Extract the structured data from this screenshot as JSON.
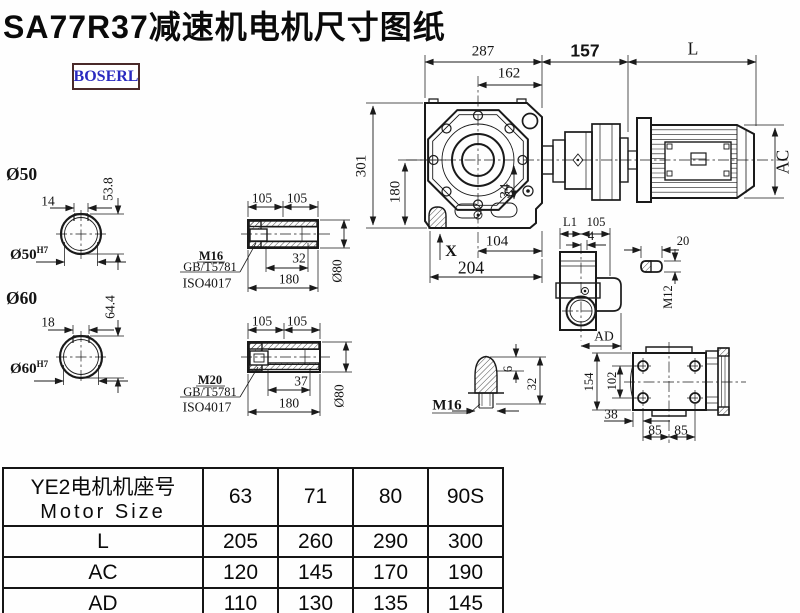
{
  "title": "SA77R37减速机电机尺寸图纸",
  "logo": "BOSERL",
  "colors": {
    "ink": "#1a1a1a",
    "logo_text": "#2a2ac0",
    "logo_border": "#4a2a2a"
  },
  "main_view": {
    "dim_287": "287",
    "dim_162": "162",
    "dim_157": "157",
    "dim_L": "L",
    "dim_301": "301",
    "dim_180": "180",
    "dim_34": "34",
    "label_X": "X",
    "dim_104": "104",
    "dim_204": "204",
    "dim_AC": "AC"
  },
  "shaft50": {
    "callout": "Ø50",
    "key_width": "14",
    "key_height": "53.8",
    "bore": "Ø50",
    "fit": "H7"
  },
  "shaft60": {
    "callout": "Ø60",
    "key_width": "18",
    "key_height": "64.4",
    "bore": "Ø60",
    "fit": "H7"
  },
  "sleeve_top": {
    "dim_105_left": "105",
    "dim_105_right": "105",
    "screw": "M16",
    "standard_1": "GB/T5781",
    "standard_2": "ISO4017",
    "dim_32": "32",
    "dim_180": "180",
    "dim_dia80": "Ø80"
  },
  "sleeve_bottom": {
    "dim_105_left": "105",
    "dim_105_right": "105",
    "screw": "M20",
    "standard_1": "GB/T5781",
    "standard_2": "ISO4017",
    "dim_37": "37",
    "dim_180": "180",
    "dim_dia80": "Ø80"
  },
  "side_view": {
    "dim_L1": "L1",
    "dim_105": "105",
    "dim_4": "4",
    "dim_AD": "AD"
  },
  "key_detail": {
    "dim_20": "20",
    "thread": "M12"
  },
  "plug_detail": {
    "thread": "M16",
    "dim_6": "6",
    "dim_32": "32"
  },
  "flange_view": {
    "dim_154": "154",
    "dim_102": "102",
    "dim_38": "38",
    "dim_85_left": "85",
    "dim_85_right": "85"
  },
  "table": {
    "header": {
      "motor_cn": "YE2电机机座号",
      "motor_en": "Motor Size",
      "sizes": [
        "63",
        "71",
        "80",
        "90S"
      ]
    },
    "rows": [
      {
        "label": "L",
        "values": [
          "205",
          "260",
          "290",
          "300"
        ]
      },
      {
        "label": "AC",
        "values": [
          "120",
          "145",
          "170",
          "190"
        ]
      },
      {
        "label": "AD",
        "values": [
          "110",
          "130",
          "135",
          "145"
        ]
      }
    ]
  }
}
